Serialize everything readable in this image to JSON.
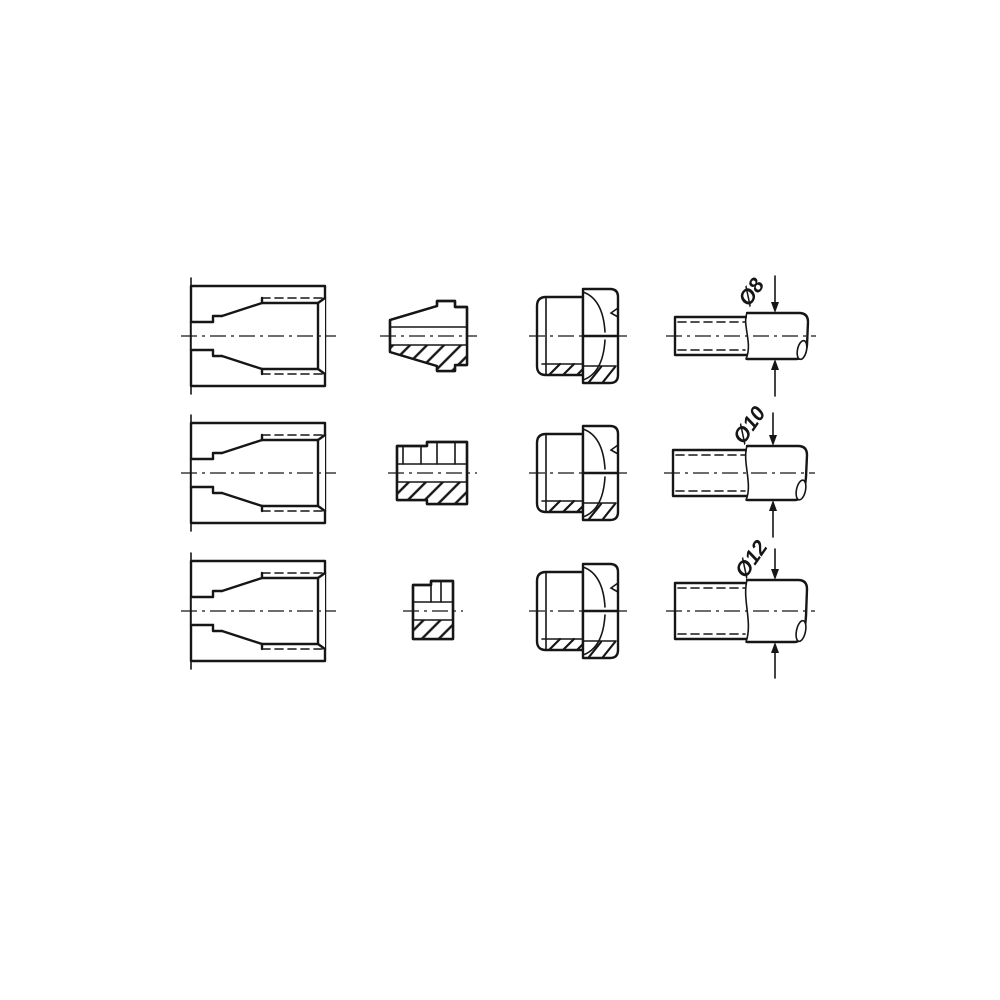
{
  "drawing": {
    "type": "technical-line-drawing",
    "colors": {
      "line": "#161616",
      "background": "#ffffff"
    },
    "rows": [
      {
        "name": "row-8",
        "diameter_label": "Ø8",
        "parts": [
          "sectioned-body",
          "ferrule",
          "cap-nut",
          "tube"
        ]
      },
      {
        "name": "row-10",
        "diameter_label": "Ø10",
        "parts": [
          "sectioned-body",
          "sleeve",
          "cap-nut",
          "tube"
        ]
      },
      {
        "name": "row-12",
        "diameter_label": "Ø12",
        "parts": [
          "sectioned-body",
          "sleeve",
          "cap-nut",
          "tube"
        ]
      }
    ]
  }
}
